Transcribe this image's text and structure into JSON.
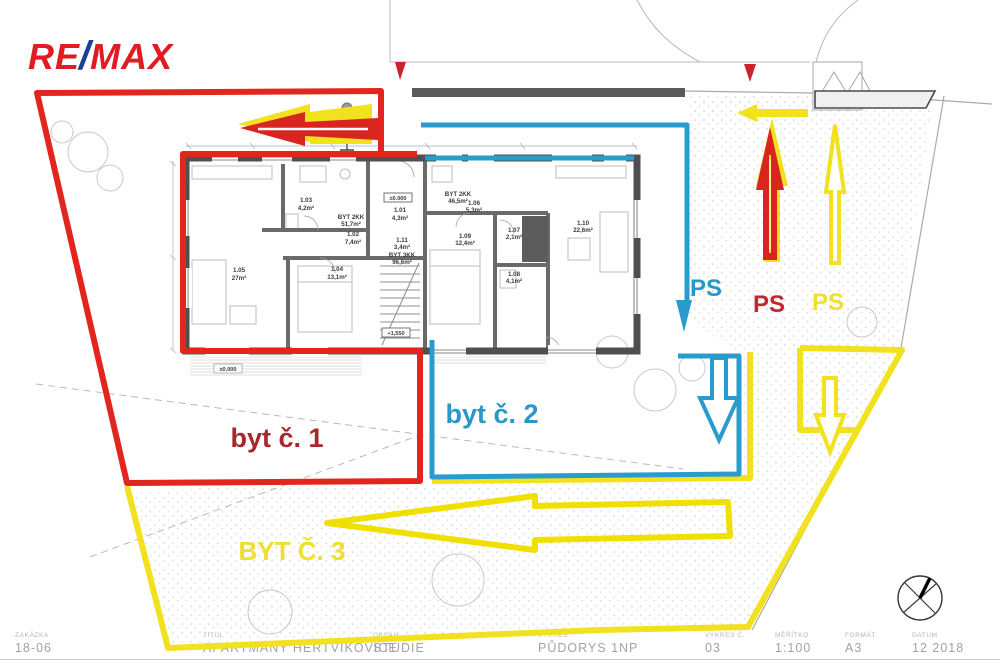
{
  "brand": {
    "re": "RE",
    "slash": "/",
    "max": "MAX",
    "red": "#e11b22",
    "blue": "#1b3f94"
  },
  "overlays": {
    "red": {
      "label": "byt č. 1",
      "ps": "PS",
      "line_color": "#e2251d",
      "text_color": "#a9272c"
    },
    "blue": {
      "label": "byt č. 2",
      "ps": "PS",
      "line_color": "#2a9bcd",
      "text_color": "#2798c9"
    },
    "yellow": {
      "label": "BYT Č. 3",
      "ps": "PS",
      "line_color": "#f2e11d",
      "text_color": "#efdf2e"
    }
  },
  "plan": {
    "apartment_tags": [
      {
        "name": "BYT 2KK",
        "area": "51,7m²"
      },
      {
        "name": "BYT 3KK",
        "area": "96,6m²"
      },
      {
        "name": "BYT 2KK",
        "area": "46,5m²"
      }
    ],
    "rooms": [
      {
        "id": "1.01",
        "area": "4,3m²"
      },
      {
        "id": "1.02",
        "area": "7,4m²"
      },
      {
        "id": "1.03",
        "area": "4,2m²"
      },
      {
        "id": "1.04",
        "area": "13,1m²"
      },
      {
        "id": "1.05",
        "area": "27m²"
      },
      {
        "id": "1.06",
        "area": "5,3m²"
      },
      {
        "id": "1.07",
        "area": "2,1m²"
      },
      {
        "id": "1.08",
        "area": "4,1m²"
      },
      {
        "id": "1.09",
        "area": "12,4m²"
      },
      {
        "id": "1.10",
        "area": "22,6m²"
      },
      {
        "id": "1.11",
        "area": "3,4m²"
      }
    ],
    "levels": [
      {
        "label": "±0.000"
      },
      {
        "label": "+1,550"
      },
      {
        "label": "±0.000"
      }
    ]
  },
  "titleblock": {
    "fields": [
      {
        "label": "ZAKÁZKA",
        "value": "18-06"
      },
      {
        "label": "TITUL",
        "value": "APARTMÁNY HERTVÍKOVICE"
      },
      {
        "label": "OBSAH",
        "value": "STUDIE"
      },
      {
        "label": "VÝKRES",
        "value": "PŮDORYS 1NP"
      },
      {
        "label": "VÝKRES Č.",
        "value": "03"
      },
      {
        "label": "MĚŘÍTKO",
        "value": "1:100"
      },
      {
        "label": "FORMÁT",
        "value": "A3"
      },
      {
        "label": "DATUM",
        "value": "12 2018"
      }
    ]
  }
}
